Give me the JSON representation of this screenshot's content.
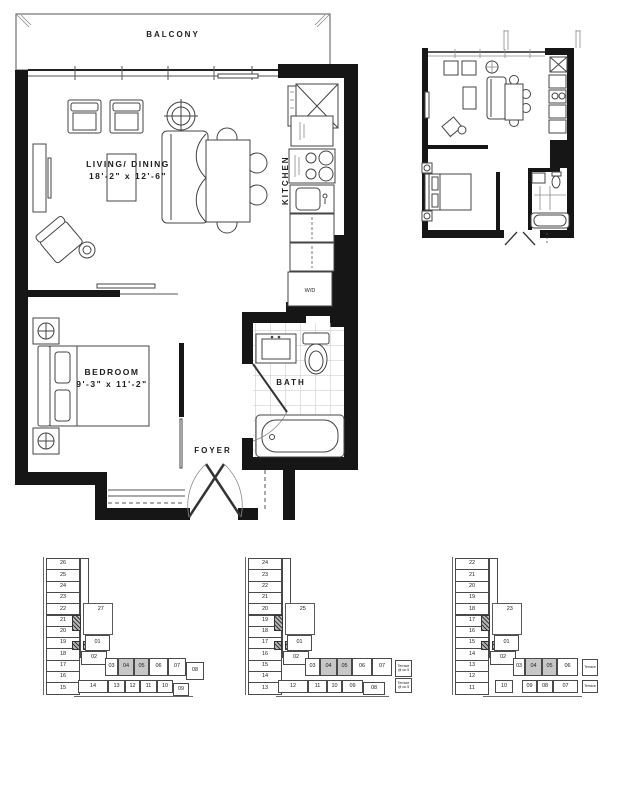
{
  "main_plan": {
    "balcony": "BALCONY",
    "living_dining_label": "LIVING/ DINING",
    "living_dining_dims": "18'-2\" x 12'-6\"",
    "kitchen": "KITCHEN",
    "bedroom_label": "BEDROOM",
    "bedroom_dims": "9'-3\" x 11'-2\"",
    "bath": "BATH",
    "foyer": "FOYER",
    "washer_dryer": "W/D"
  },
  "plates": [
    {
      "left_column": [
        "26",
        "25",
        "24",
        "23",
        "22",
        "21",
        "20",
        "19",
        "18",
        "17",
        "16",
        "15"
      ],
      "tower_unit": "27",
      "core_units": [
        "01",
        "02"
      ],
      "row_a": [
        "03",
        "04",
        "05",
        "06",
        "07",
        "08"
      ],
      "row_b": [
        "14",
        "13",
        "12",
        "11",
        "10",
        "09"
      ],
      "shaded_units": [
        "04",
        "05"
      ],
      "terraces": []
    },
    {
      "left_column": [
        "24",
        "23",
        "22",
        "21",
        "20",
        "19",
        "18",
        "17",
        "16",
        "15",
        "14",
        "13"
      ],
      "tower_unit": "25",
      "core_units": [
        "01",
        "02"
      ],
      "row_a": [
        "03",
        "04",
        "05",
        "06",
        "07"
      ],
      "row_b": [
        "12",
        "11",
        "10",
        "09",
        "08"
      ],
      "shaded_units": [
        "04",
        "05"
      ],
      "terraces": [
        "Terrace @ un.5",
        "Terrace @ un.5"
      ]
    },
    {
      "left_column": [
        "22",
        "21",
        "20",
        "19",
        "18",
        "17",
        "16",
        "15",
        "14",
        "13",
        "12",
        "11"
      ],
      "tower_unit": "23",
      "core_units": [
        "01",
        "02"
      ],
      "row_a": [
        "03",
        "04",
        "05",
        "06"
      ],
      "row_b": [
        "10",
        "09",
        "08",
        "07"
      ],
      "shaded_units": [
        "04",
        "05"
      ],
      "terraces": [
        "Terrace",
        "Terrace"
      ]
    }
  ],
  "colors": {
    "wall": "#161616",
    "line": "#444444",
    "shaded_unit": "#c7c7c7",
    "tile": "#c4c4c4"
  }
}
